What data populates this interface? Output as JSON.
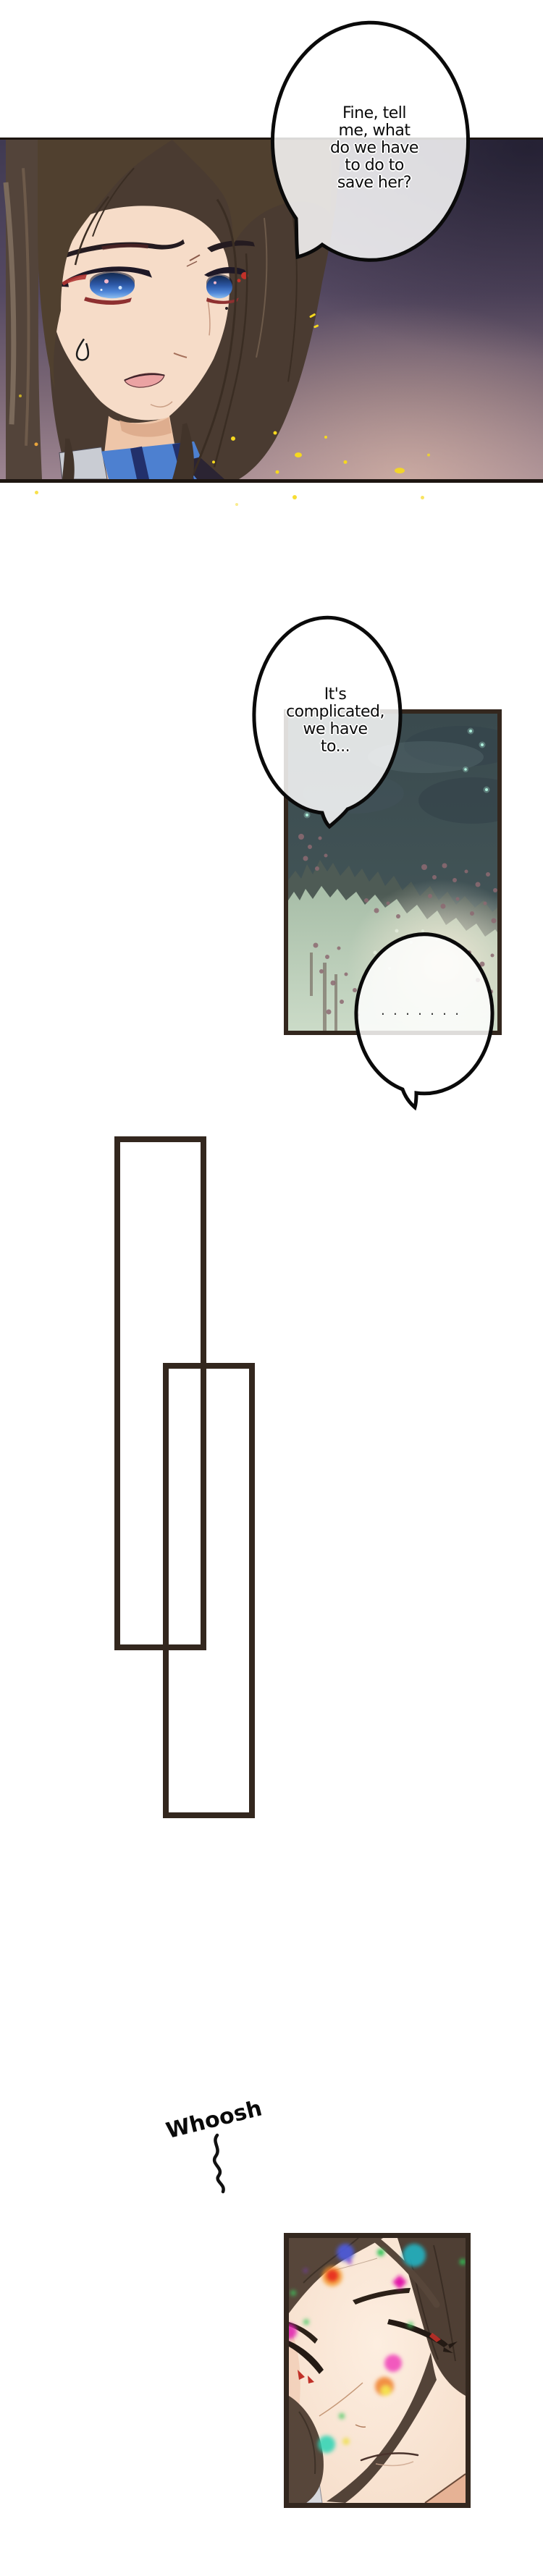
{
  "comic": {
    "bubble1_text": "Fine, tell\nme, what\ndo we have\nto do to\nsave her?",
    "bubble2_text": "It's\ncomplicated,\nwe have\nto...",
    "bubble3_dots": "·······",
    "whoosh": "Whoosh"
  },
  "colors": {
    "page-bg": "#ffffff",
    "ink": "#0a0a0a",
    "panel-border": "#33271e",
    "panel1-border": "#1d1510",
    "bubble-fill": "#ffffff",
    "bubble-opacity": "0.84",
    "hair": "#4a3b31",
    "hair-dark": "#3a2d23",
    "hair-light": "#6d5a4a",
    "skin": "#f6dcc8",
    "skin-shadow": "#e9bfa0",
    "eye-blue": "#2c57a5",
    "eye-blue-light": "#8fc0f0",
    "eyeliner-red": "#b03432",
    "collar-blue": "#4d80d0",
    "collar-navy": "#22306b",
    "garment-gray": "#c9ccd3",
    "sparkle-yellow": "#f6d91e",
    "panel1-bg-top": "#3a3450",
    "panel1-bg-bottom": "#a28a94",
    "night-sky-top": "#3a4a4e",
    "night-sky-bottom": "#475a5c",
    "cloud-dark": "#35444b",
    "star-cyan": "#aef0dc",
    "tree-dark": "#4e5b55",
    "tree-mint": "#a9bfa9",
    "tree-mauve": "#8d6a72",
    "glow-beige": "#f0e8d6",
    "skin2": "#f8e2d2",
    "neck-shadow": "#e6b295",
    "bokeh": [
      "#4c5bdf",
      "#e83420",
      "#f59a2a",
      "#2fc457",
      "#22b8c9",
      "#e316a9",
      "#f040b8",
      "#f08028",
      "#f5e050",
      "#2bd4b4"
    ]
  }
}
